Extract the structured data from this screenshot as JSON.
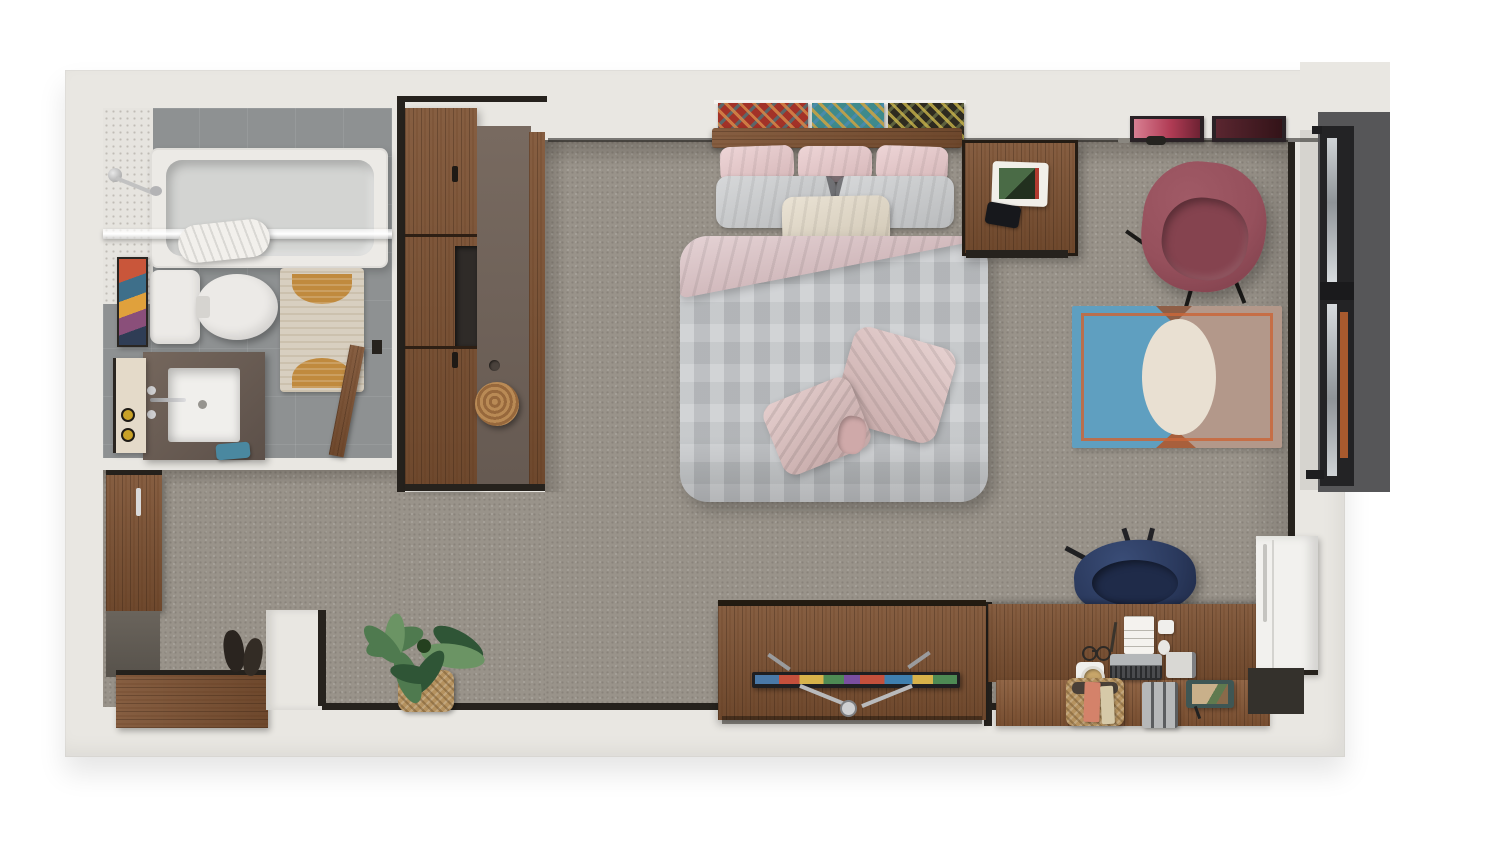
{
  "meta": {
    "scene": "studio-apartment-3d-floor-plan-top-view",
    "style": "photoreal-render-recreation"
  },
  "palette": {
    "wall": "#e9e7e2",
    "wall_dark": "#d6d4cf",
    "carpet": "#99938a",
    "tile": "#8e9192",
    "tile_wall": "#e6e4df",
    "black": "#26221d",
    "wood": "#7d5233",
    "wood_dark": "#5e3d22",
    "counter": "#6e6057",
    "tub": "#eceae6",
    "tub_inner": "#d3d4d2",
    "porcelain": "#eceae7",
    "bath_rug_cream": "#d8cfc0",
    "bath_rug_orange": "#c08a3e",
    "towel_blue": "#4a88a0",
    "armchair": "#96505c",
    "armchair_seat": "#85434f",
    "desk_chair": "#2b3a5e",
    "desk_chair_seat": "#1f2b49",
    "rug_blue": "#5f9fc0",
    "rug_tan": "#b3988a",
    "rug_cream": "#e9e0d2",
    "rug_orange": "#c9663a",
    "duvet": "#c3c6c9",
    "pink_fold": "#dfc6c9",
    "throw_pink": "#d9b9b8",
    "pillow_pink": "#e8c7c9",
    "pillow_gray": "#c9cbcd",
    "pillow_cream": "#e3d9c6",
    "window_bay": "#565658",
    "window_frame": "#232325",
    "curtain": "#a85a2e",
    "glass_hi": "#cfd3d6",
    "basket": "#b5925f",
    "plant_dark": "#2f5536",
    "plant_mid": "#4f7a4f",
    "plant_light": "#6b9464",
    "white_cabinet": "#f2f1ee",
    "metal": "#b9babc"
  },
  "scene": {
    "bathroom": {
      "items": [
        "bathtub",
        "shower-head",
        "shower-glass-screen",
        "rolled-towel",
        "toilet",
        "patterned-bath-rug",
        "vanity-with-square-sink",
        "wall-art",
        "storage-shelf",
        "blue-hand-towel",
        "open-door"
      ]
    },
    "closet": {
      "items": [
        "tall-wardrobe-cabinets",
        "open-shelf-niche",
        "counter-panel",
        "round-wood-stool"
      ]
    },
    "bedroom": {
      "items": [
        "double-bed",
        "three-pink-pillows",
        "two-gray-pillows",
        "cream-lumbar-pillow",
        "gray-duvet",
        "pink-folded-blanket",
        "pink-ruffle-throw",
        "wood-headboard",
        "triptych-art-panels",
        "nightstand",
        "decor-tray",
        "phone",
        "pink-framed-print",
        "maroon-framed-print",
        "red-swivel-armchair",
        "two-tone-area-rug",
        "window-bay-with-orange-curtain"
      ]
    },
    "office": {
      "items": [
        "l-desk",
        "navy-task-chair",
        "notepad",
        "pen",
        "reading-glasses",
        "keyboard",
        "tablet",
        "cup-on-coaster",
        "basket-with-books",
        "file-organizer",
        "photo-tray",
        "white-storage-cabinet"
      ]
    },
    "living": {
      "items": [
        "media-console",
        "flat-tv-on-v-stand"
      ]
    },
    "entry": {
      "items": [
        "wood-cabinet",
        "wood-bench",
        "shoes",
        "partition-stub-wall",
        "monstera-plant-in-basket"
      ]
    }
  }
}
